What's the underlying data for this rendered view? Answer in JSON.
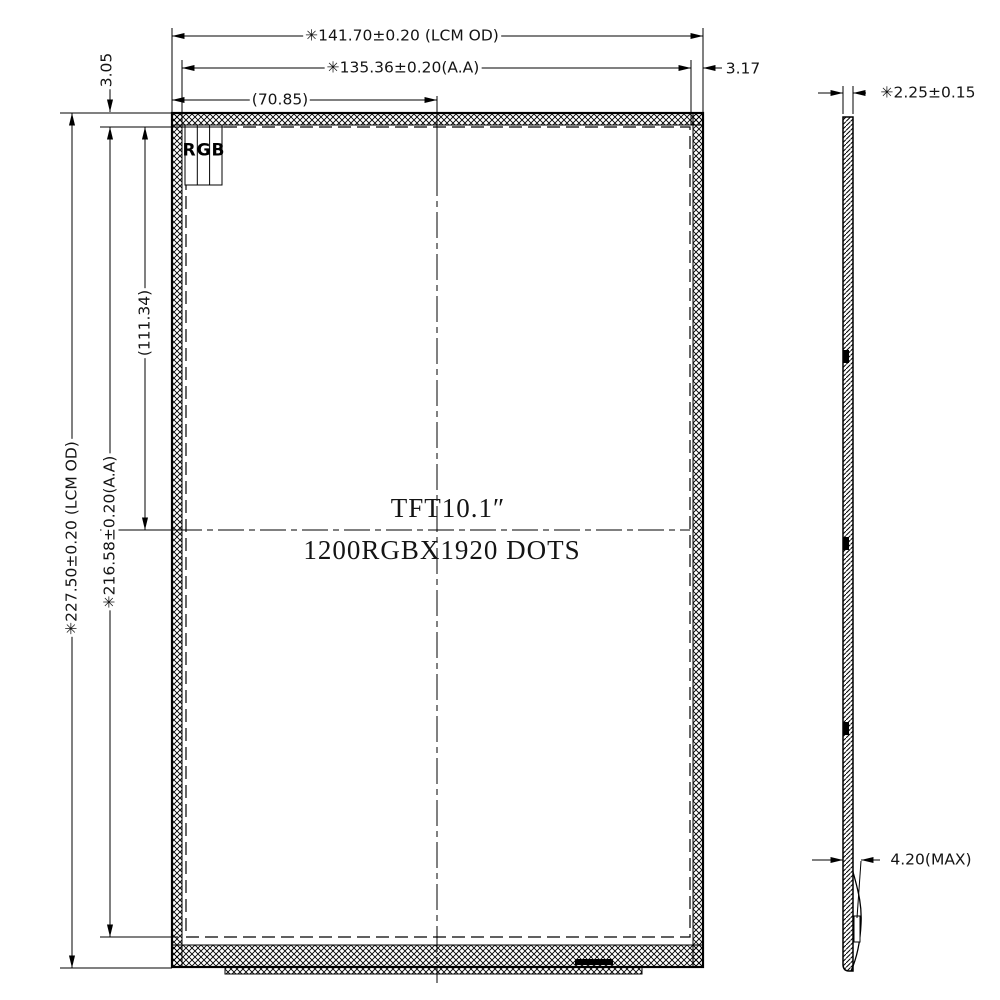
{
  "drawing": {
    "type": "mechanical outline drawing",
    "units_note": "mm"
  },
  "front_view": {
    "dims": {
      "lcm_width": "✳141.70±0.20 (LCM OD)",
      "aa_width": "✳135.36±0.20(A.A)",
      "half_width": "(70.85)",
      "right_margin": "3.17",
      "top_margin": "3.05",
      "lcm_height": "✳227.50±0.20 (LCM OD)",
      "aa_height": "✳216.58±0.20(A.A)",
      "half_height": "(111.34)"
    },
    "labels": {
      "rgb": "RGB",
      "screen_line1": "TFT10.1″",
      "screen_line2": "1200RGBX1920 DOTS"
    }
  },
  "side_view": {
    "dims": {
      "thickness": "✳2.25±0.15",
      "max_thickness": "4.20(MAX)"
    }
  },
  "colors": {
    "line": "#000000",
    "background": "#ffffff"
  }
}
